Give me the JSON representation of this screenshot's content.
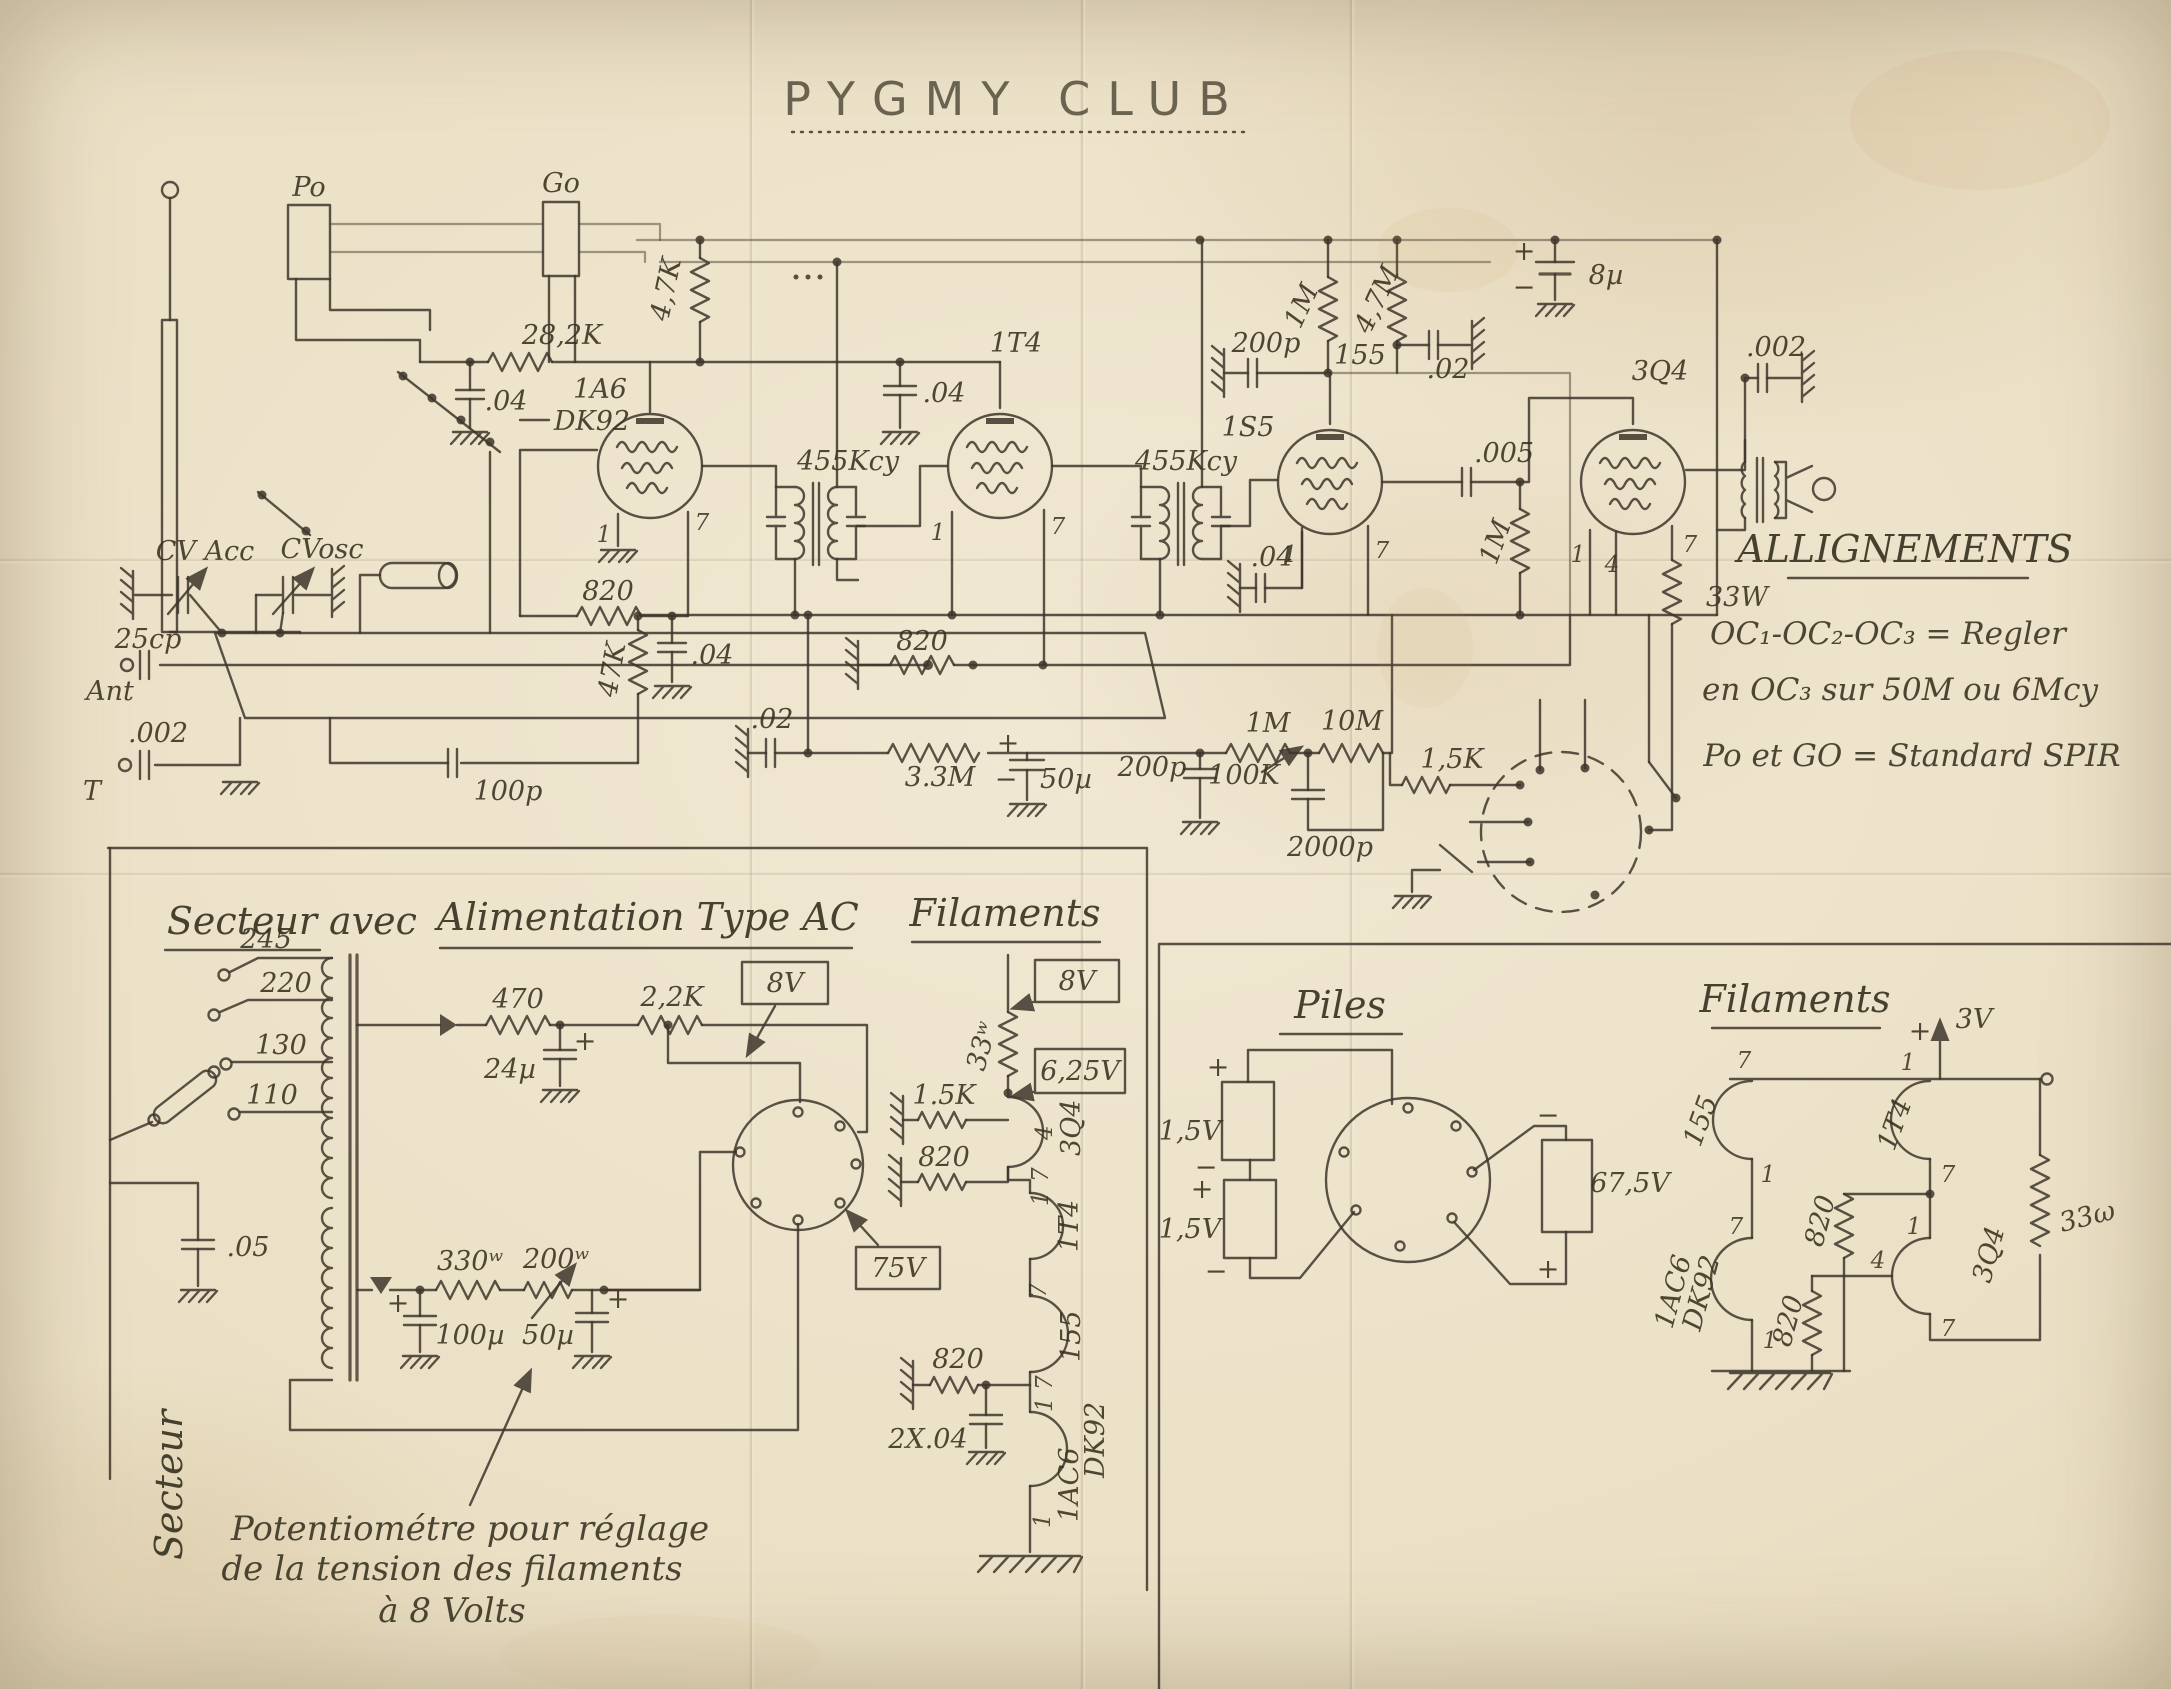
{
  "title": {
    "text": "PYGMY CLUB"
  },
  "sym": {
    "plus": "+",
    "minus": "−"
  },
  "pins": {
    "p1": "1",
    "p4": "4",
    "p7": "7"
  },
  "main": {
    "po": "Po",
    "go": "Go",
    "cv_acc": "CV Acc",
    "cv_osc": "CVosc",
    "ant_cap": "25cp",
    "ant": "Ant",
    "t_cap": ".002",
    "t": "T",
    "r_28k": "28,2K",
    "c_04_sg": ".04",
    "tube_1a6": "1A6",
    "tube_dk92": "DK92",
    "r_47k_v": "4,7K",
    "r_820_osc": "820",
    "r_47k": "47K",
    "c_04_osc": ".04",
    "c_100p": "100p",
    "if1": "455Kcy",
    "if2": "455Kcy",
    "tube_1t4": "1T4",
    "c_04_1t4": ".04",
    "r_820_if": "820",
    "c_02_osc": ".02",
    "r_33m": "3.3M",
    "c_50u": "50µ",
    "c_200p_b": "200p",
    "r_1m_vol": "1M",
    "r_10m": "10M",
    "pot_100k": "100K",
    "c_2000p": "2000p",
    "r_15k": "1,5K",
    "c_04_if2": ".04",
    "tube_1s5": "1S5",
    "c_200p_a": "200p",
    "r_1m_a": "1M",
    "r_47m": "4,7M",
    "net155": "155",
    "c_02_det": ".02",
    "c_8u": "8µ",
    "c_005": ".005",
    "r_1m_g": "1M",
    "tube_3q4": "3Q4",
    "r_33w": "33W",
    "c_002_out": ".002"
  },
  "align": {
    "head": "ALLIGNEMENTS",
    "l1": "OC₁-OC₂-OC₃ = Regler",
    "l2": "en OC₃ sur 50M ou 6Mcy",
    "l3": "Po et GO = Standard SPIR"
  },
  "psu": {
    "h1": "Secteur",
    "h2": "avec",
    "h3": "Alimentation Type AC",
    "h4": "Filaments",
    "tap245": "245",
    "tap220": "220",
    "tap130": "130",
    "tap110": "110",
    "r_470": "470",
    "r_22k": "2,2K",
    "c_24u": "24µ",
    "v8": "8V",
    "c_05": ".05",
    "r_330": "330ʷ",
    "pot_200": "200ʷ",
    "c_100u": "100µ",
    "c_50u": "50µ",
    "v75": "75V",
    "secteur": "Secteur",
    "note1": "Potentiométre pour réglage",
    "note2": "de la tension des filaments",
    "note3": "à 8 Volts"
  },
  "filac": {
    "v8": "8V",
    "r_33": "33ʷ",
    "v625": "6,25V",
    "r_15k": "1.5K",
    "t_3q4": "3Q4",
    "t_1t4": "1T4",
    "t_155": "155",
    "r_820a": "820",
    "r_820b": "820",
    "c_2x04": "2X.04",
    "t_1ac6": "1AC6",
    "t_dk92": "DK92"
  },
  "piles": {
    "head": "Piles",
    "b15a": "1,5V",
    "b15b": "1,5V",
    "b675": "67,5V"
  },
  "filbat": {
    "head": "Filaments",
    "v3": "3V",
    "t_155": "155",
    "t_1t4": "1T4",
    "t_1ac6": "1AC6",
    "t_dk92": "DK92",
    "t_3q4": "3Q4",
    "r_820a": "820",
    "r_820b": "820",
    "r_33": "33ω"
  }
}
